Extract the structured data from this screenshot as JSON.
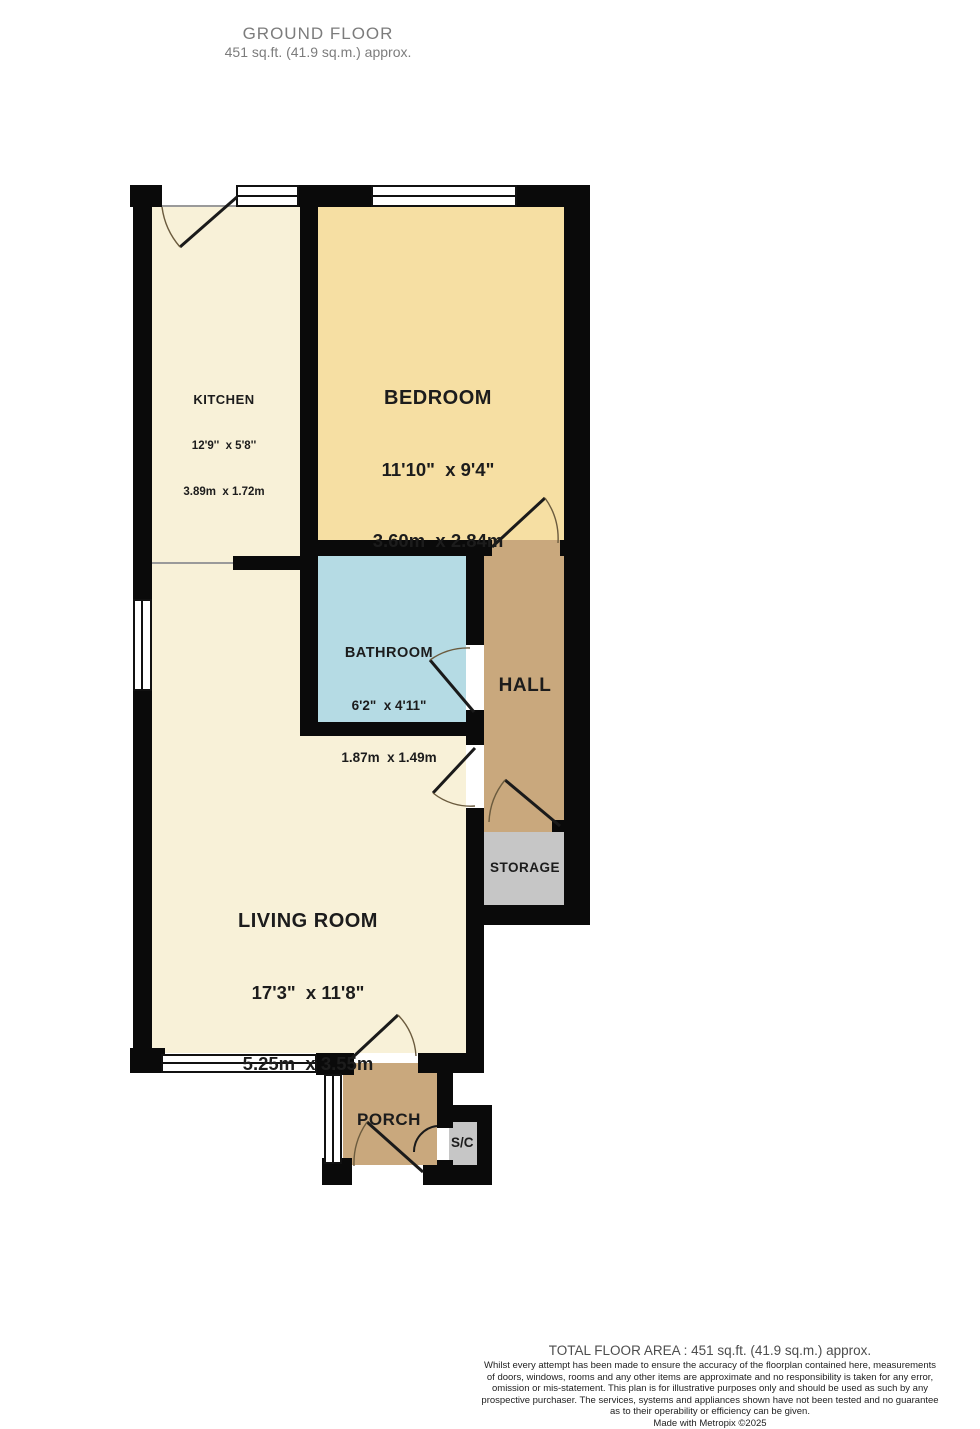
{
  "header": {
    "title": "GROUND FLOOR",
    "subtitle": "451 sq.ft. (41.9 sq.m.) approx."
  },
  "rooms": {
    "kitchen": {
      "name": "KITCHEN",
      "dims_imperial": "12'9''  x 5'8''",
      "dims_metric": "3.89m  x 1.72m"
    },
    "bedroom": {
      "name": "BEDROOM",
      "dims_imperial": "11'10\"  x 9'4\"",
      "dims_metric": "3.60m  x 2.84m"
    },
    "bathroom": {
      "name": "BATHROOM",
      "dims_imperial": "6'2\"  x 4'11\"",
      "dims_metric": "1.87m  x 1.49m"
    },
    "hall": {
      "name": "HALL"
    },
    "living_room": {
      "name": "LIVING ROOM",
      "dims_imperial": "17'3\"  x 11'8\"",
      "dims_metric": "5.25m  x 3.55m"
    },
    "storage": {
      "name": "STORAGE"
    },
    "porch": {
      "name": "PORCH"
    },
    "store_cupboard": {
      "name": "S/C"
    }
  },
  "colors": {
    "wall": "#0a0a0a",
    "cream": "#f8f1d8",
    "bedroom": "#f6dfa3",
    "bathroom": "#b5dbe4",
    "hall": "#c9a87d",
    "storage": "#c6c6c6",
    "window": "#ffffff"
  },
  "footer": {
    "total": "TOTAL FLOOR AREA : 451 sq.ft. (41.9 sq.m.) approx.",
    "disclaimer_lines": [
      "Whilst every attempt has been made to ensure the accuracy of the floorplan contained here, measurements",
      "of doors, windows, rooms and any other items are approximate and no responsibility is taken for any error,",
      "omission or mis-statement. This plan is for illustrative purposes only and should be used as such by any",
      "prospective purchaser. The services, systems and appliances shown have not been tested and no guarantee",
      "as to their operability or efficiency can be given.",
      "Made with Metropix ©2025"
    ]
  }
}
